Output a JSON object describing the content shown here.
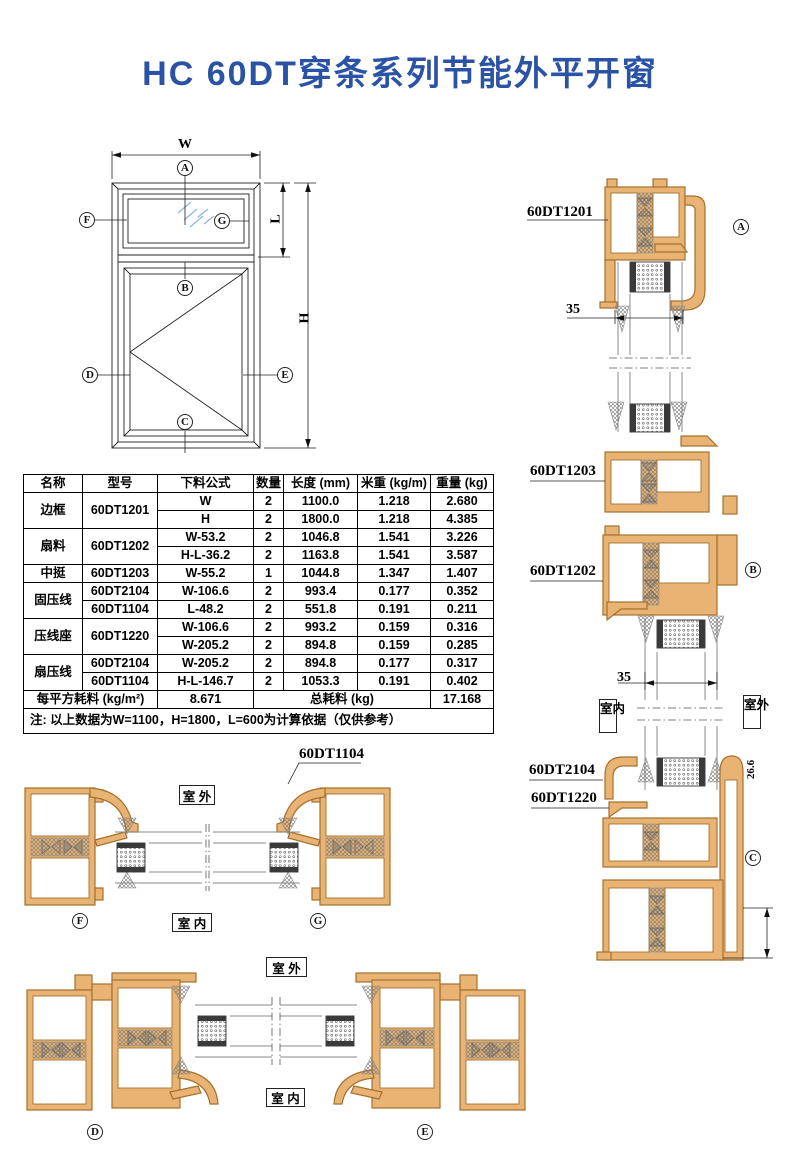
{
  "title": "HC 60DT穿条系列节能外平开窗",
  "colors": {
    "title_blue": "#2b53a5",
    "profile_fill": "#e9b473",
    "profile_stroke": "#a4702e"
  },
  "elevation": {
    "dim_width": "W",
    "dim_upper_height": "L",
    "dim_height": "H",
    "markers": {
      "a": "A",
      "b": "B",
      "c": "C",
      "d": "D",
      "e": "E",
      "f": "F",
      "g": "G"
    }
  },
  "table": {
    "headers": [
      "名称",
      "型号",
      "下料公式",
      "数量",
      "长度 (mm)",
      "米重 (kg/m)",
      "重量 (kg)"
    ],
    "groups": [
      {
        "name": "边框",
        "model": "60DT1201",
        "lines": [
          {
            "formula": "W",
            "qty": "2",
            "length": "1100.0",
            "kg_per_m": "1.218",
            "weight": "2.680"
          },
          {
            "formula": "H",
            "qty": "2",
            "length": "1800.0",
            "kg_per_m": "1.218",
            "weight": "4.385"
          }
        ]
      },
      {
        "name": "扇料",
        "model": "60DT1202",
        "lines": [
          {
            "formula": "W-53.2",
            "qty": "2",
            "length": "1046.8",
            "kg_per_m": "1.541",
            "weight": "3.226"
          },
          {
            "formula": "H-L-36.2",
            "qty": "2",
            "length": "1163.8",
            "kg_per_m": "1.541",
            "weight": "3.587"
          }
        ]
      },
      {
        "name": "中挺",
        "model": "60DT1203",
        "lines": [
          {
            "formula": "W-55.2",
            "qty": "1",
            "length": "1044.8",
            "kg_per_m": "1.347",
            "weight": "1.407"
          }
        ]
      },
      {
        "name": "固压线",
        "lines": [
          {
            "model": "60DT2104",
            "formula": "W-106.6",
            "qty": "2",
            "length": "993.4",
            "kg_per_m": "0.177",
            "weight": "0.352"
          },
          {
            "model": "60DT1104",
            "formula": "L-48.2",
            "qty": "2",
            "length": "551.8",
            "kg_per_m": "0.191",
            "weight": "0.211"
          }
        ]
      },
      {
        "name": "压线座",
        "model": "60DT1220",
        "lines": [
          {
            "formula": "W-106.6",
            "qty": "2",
            "length": "993.2",
            "kg_per_m": "0.159",
            "weight": "0.316"
          },
          {
            "formula": "W-205.2",
            "qty": "2",
            "length": "894.8",
            "kg_per_m": "0.159",
            "weight": "0.285"
          }
        ]
      },
      {
        "name": "扇压线",
        "lines": [
          {
            "model": "60DT2104",
            "formula": "W-205.2",
            "qty": "2",
            "length": "894.8",
            "kg_per_m": "0.177",
            "weight": "0.317"
          },
          {
            "model": "60DT1104",
            "formula": "H-L-146.7",
            "qty": "2",
            "length": "1053.3",
            "kg_per_m": "0.191",
            "weight": "0.402"
          }
        ]
      }
    ],
    "summary": {
      "per_sqm_label": "每平方耗料 (kg/m²)",
      "per_sqm_value": "8.671",
      "total_label": "总耗料 (kg)",
      "total_value": "17.168"
    },
    "note": "注: 以上数据为W=1100，H=1800，L=600为计算依据（仅供参考）"
  },
  "sections": {
    "right_top": {
      "profile_label": "60DT1201",
      "marker": "A",
      "dim": "35"
    },
    "right_mid": {
      "label_mullion": "60DT1203",
      "label_sash": "60DT1202",
      "marker": "B",
      "dim": "35",
      "indoor": "室内",
      "outdoor": "室外"
    },
    "right_bottom": {
      "label_bead": "60DT2104",
      "label_seat": "60DT1220",
      "marker": "C",
      "dim": "26.6"
    },
    "fg": {
      "label": "60DT1104",
      "outdoor": "室 外",
      "indoor": "室 内",
      "marker_left": "F",
      "marker_right": "G"
    },
    "de": {
      "outdoor": "室 外",
      "indoor": "室 内",
      "marker_left": "D",
      "marker_right": "E"
    }
  }
}
